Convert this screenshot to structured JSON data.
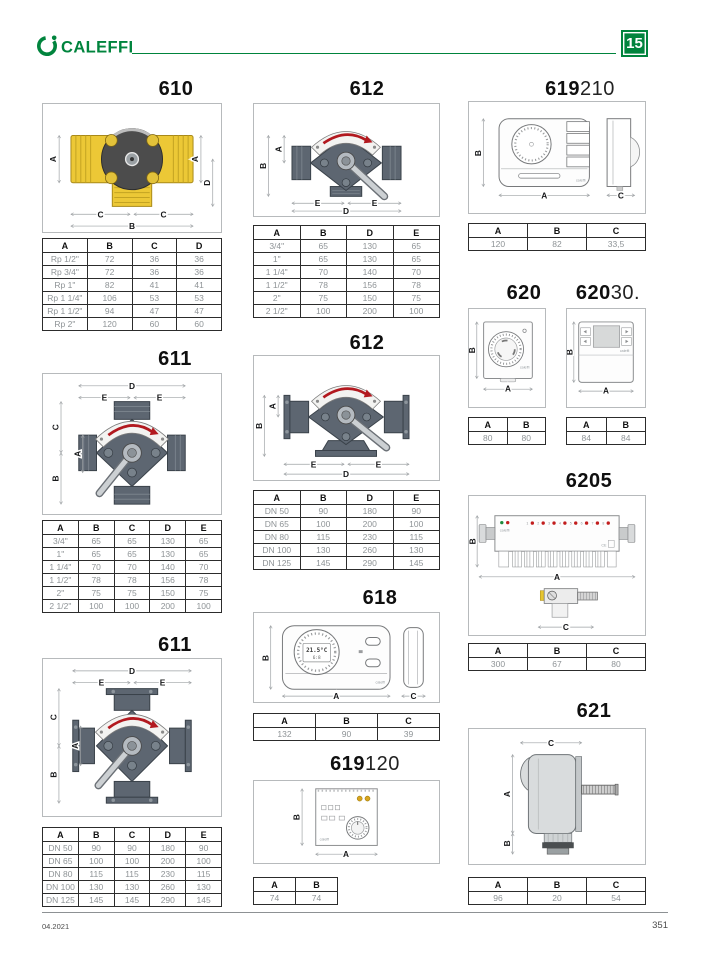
{
  "header": {
    "brand": "CALEFFI",
    "section_badge": "15"
  },
  "footer": {
    "edition": "04.2021",
    "page_number": "351"
  },
  "shared": {
    "device_brand": "caleffi",
    "ce_mark": "CE"
  },
  "products": {
    "p610": {
      "code": "610",
      "dims": [
        "A",
        "A",
        "D",
        "C",
        "C",
        "B"
      ],
      "table": {
        "headers": [
          "A",
          "B",
          "C",
          "D"
        ],
        "rows": [
          [
            "Rp 1/2\"",
            "72",
            "36",
            "36"
          ],
          [
            "Rp 3/4\"",
            "72",
            "36",
            "36"
          ],
          [
            "Rp 1\"",
            "82",
            "41",
            "41"
          ],
          [
            "Rp 1 1/4\"",
            "106",
            "53",
            "53"
          ],
          [
            "Rp 1 1/2\"",
            "94",
            "47",
            "47"
          ],
          [
            "Rp 2\"",
            "120",
            "60",
            "60"
          ]
        ]
      }
    },
    "p611a": {
      "code": "611",
      "dims": [
        "D",
        "E",
        "E",
        "C",
        "A",
        "B"
      ],
      "table": {
        "headers": [
          "A",
          "B",
          "C",
          "D",
          "E"
        ],
        "rows": [
          [
            "3/4\"",
            "65",
            "65",
            "130",
            "65"
          ],
          [
            "1\"",
            "65",
            "65",
            "130",
            "65"
          ],
          [
            "1 1/4\"",
            "70",
            "70",
            "140",
            "70"
          ],
          [
            "1 1/2\"",
            "78",
            "78",
            "156",
            "78"
          ],
          [
            "2\"",
            "75",
            "75",
            "150",
            "75"
          ],
          [
            "2 1/2\"",
            "100",
            "100",
            "200",
            "100"
          ]
        ]
      }
    },
    "p611b": {
      "code": "611",
      "dims": [
        "D",
        "E",
        "E",
        "C",
        "A",
        "B"
      ],
      "table": {
        "headers": [
          "A",
          "B",
          "C",
          "D",
          "E"
        ],
        "rows": [
          [
            "DN 50",
            "90",
            "90",
            "180",
            "90"
          ],
          [
            "DN 65",
            "100",
            "100",
            "200",
            "100"
          ],
          [
            "DN 80",
            "115",
            "115",
            "230",
            "115"
          ],
          [
            "DN 100",
            "130",
            "130",
            "260",
            "130"
          ],
          [
            "DN 125",
            "145",
            "145",
            "290",
            "145"
          ]
        ]
      }
    },
    "p612a": {
      "code": "612",
      "dims": [
        "A",
        "B",
        "E",
        "E",
        "D"
      ],
      "table": {
        "headers": [
          "A",
          "B",
          "D",
          "E"
        ],
        "rows": [
          [
            "3/4\"",
            "65",
            "130",
            "65"
          ],
          [
            "1\"",
            "65",
            "130",
            "65"
          ],
          [
            "1 1/4\"",
            "70",
            "140",
            "70"
          ],
          [
            "1 1/2\"",
            "78",
            "156",
            "78"
          ],
          [
            "2\"",
            "75",
            "150",
            "75"
          ],
          [
            "2 1/2\"",
            "100",
            "200",
            "100"
          ]
        ]
      }
    },
    "p612b": {
      "code": "612",
      "dims": [
        "A",
        "B",
        "E",
        "E",
        "D"
      ],
      "table": {
        "headers": [
          "A",
          "B",
          "D",
          "E"
        ],
        "rows": [
          [
            "DN 50",
            "90",
            "180",
            "90"
          ],
          [
            "DN 65",
            "100",
            "200",
            "100"
          ],
          [
            "DN 80",
            "115",
            "230",
            "115"
          ],
          [
            "DN 100",
            "130",
            "260",
            "130"
          ],
          [
            "DN 125",
            "145",
            "290",
            "145"
          ]
        ]
      }
    },
    "p618": {
      "code": "618",
      "dims": [
        "B",
        "A",
        "C"
      ],
      "display": {
        "temp": "21.5°C",
        "time": "6:8"
      },
      "table": {
        "headers": [
          "A",
          "B",
          "C"
        ],
        "rows": [
          [
            "132",
            "90",
            "39"
          ]
        ]
      }
    },
    "p619120": {
      "code": "619",
      "suffix": "120",
      "dims": [
        "B",
        "A"
      ],
      "table": {
        "headers": [
          "A",
          "B"
        ],
        "rows": [
          [
            "74",
            "74"
          ]
        ]
      }
    },
    "p619210": {
      "code": "619",
      "suffix": "210",
      "dims": [
        "B",
        "A",
        "C"
      ],
      "table": {
        "headers": [
          "A",
          "B",
          "C"
        ],
        "rows": [
          [
            "120",
            "82",
            "33,5"
          ]
        ]
      }
    },
    "p620": {
      "code": "620",
      "dims": [
        "B",
        "A"
      ],
      "table": {
        "headers": [
          "A",
          "B"
        ],
        "rows": [
          [
            "80",
            "80"
          ]
        ]
      }
    },
    "p62030": {
      "code": "620",
      "suffix": "30.",
      "dims": [
        "B",
        "A"
      ],
      "table": {
        "headers": [
          "A",
          "B"
        ],
        "rows": [
          [
            "84",
            "84"
          ]
        ]
      }
    },
    "p6205": {
      "code": "6205",
      "dims": [
        "B",
        "A",
        "C"
      ],
      "leds": [
        "1",
        "2",
        "3",
        "4",
        "5",
        "6",
        "7",
        "8"
      ],
      "table": {
        "headers": [
          "A",
          "B",
          "C"
        ],
        "rows": [
          [
            "300",
            "67",
            "80"
          ]
        ]
      }
    },
    "p621": {
      "code": "621",
      "dims": [
        "C",
        "A",
        "B"
      ],
      "table": {
        "headers": [
          "A",
          "B",
          "C"
        ],
        "rows": [
          [
            "96",
            "20",
            "54"
          ]
        ]
      }
    }
  }
}
